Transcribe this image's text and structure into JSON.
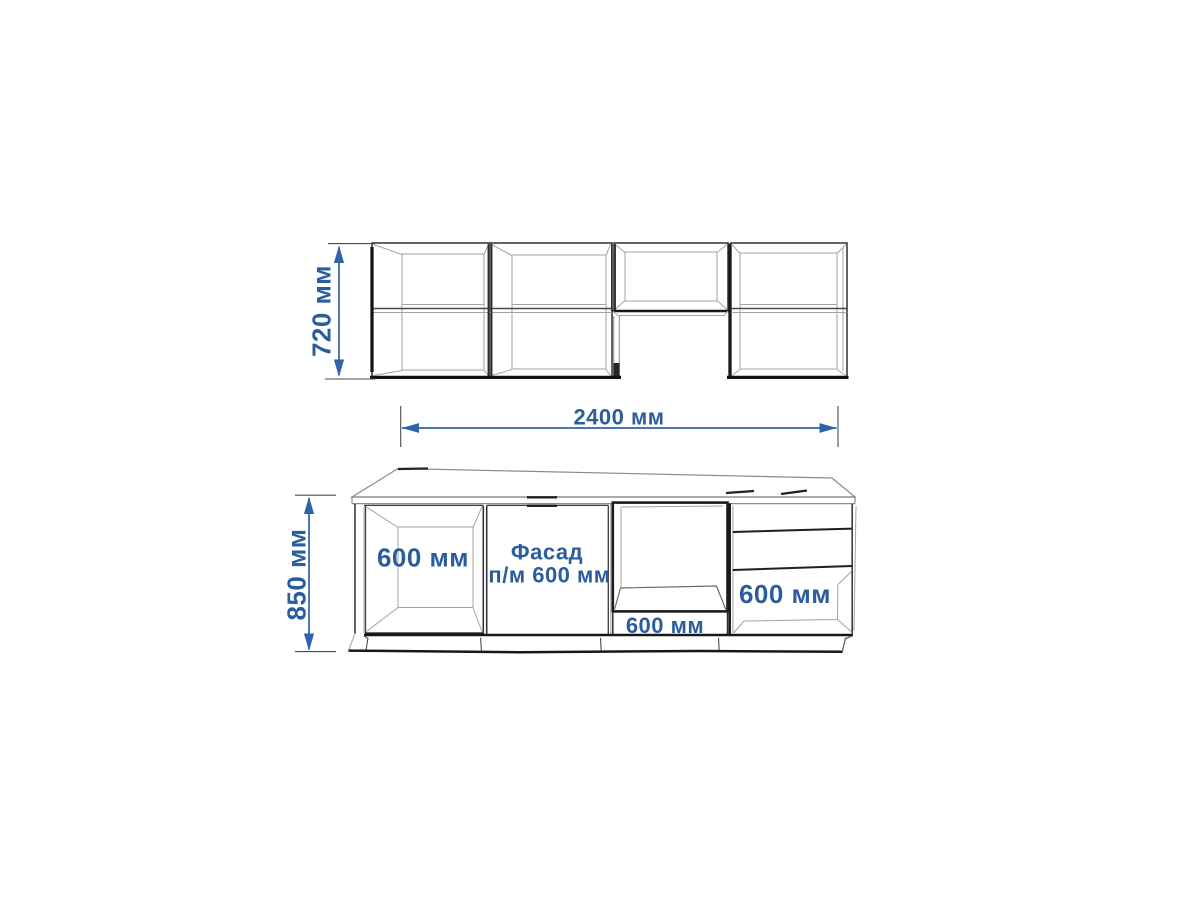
{
  "figure": {
    "type": "kitchen-set-dimension-drawing"
  },
  "dimensions": {
    "wall_cabinets_height": "720 мм",
    "total_length": "2400 мм",
    "base_height": "850 мм"
  },
  "labels": {
    "base_open_cabinet": "600 мм",
    "facade_line1": "Фасад",
    "facade_line2": "п/м 600 мм",
    "oven_cabinet": "600 мм",
    "drawer_cabinet": "600 мм"
  },
  "colors": {
    "dimension_text": "#2b5c9d",
    "dimension_line": "#2f63ab",
    "outline": "#3c3c3c",
    "heavy_line": "#181818",
    "thin_line": "#a3a3a3",
    "background": "#ffffff"
  }
}
